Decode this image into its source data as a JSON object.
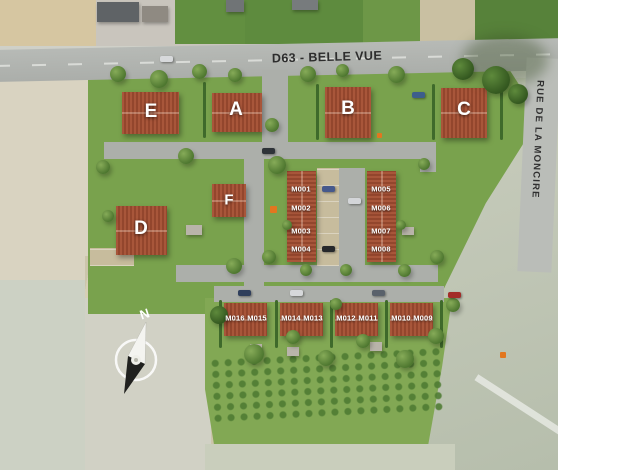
{
  "plan": {
    "streets": {
      "main_road_label": "D63 - BELLE VUE",
      "side_road_label": "RUE DE LA MONCIRE"
    },
    "buildings": [
      {
        "label": "E"
      },
      {
        "label": "A"
      },
      {
        "label": "B"
      },
      {
        "label": "C"
      },
      {
        "label": "D"
      },
      {
        "label": "F"
      }
    ],
    "terrace_left_units": [
      "M001",
      "M002",
      "M003",
      "M004"
    ],
    "terrace_right_units": [
      "M005",
      "M006",
      "M007",
      "M008"
    ],
    "bottom_units_pairs": [
      [
        "M016",
        "M015"
      ],
      [
        "M014",
        "M013"
      ],
      [
        "M012",
        "M011"
      ],
      [
        "M010",
        "M009"
      ]
    ],
    "compass_north_label": "N",
    "colors": {
      "roof_red": "#a2543a",
      "grass_green": "#79a24d",
      "road_grey": "#b2b5b1",
      "sand_beige": "#d6cfb6",
      "water_grey_green": "#c3c8b7",
      "accent_orange": "#e2761f"
    }
  }
}
